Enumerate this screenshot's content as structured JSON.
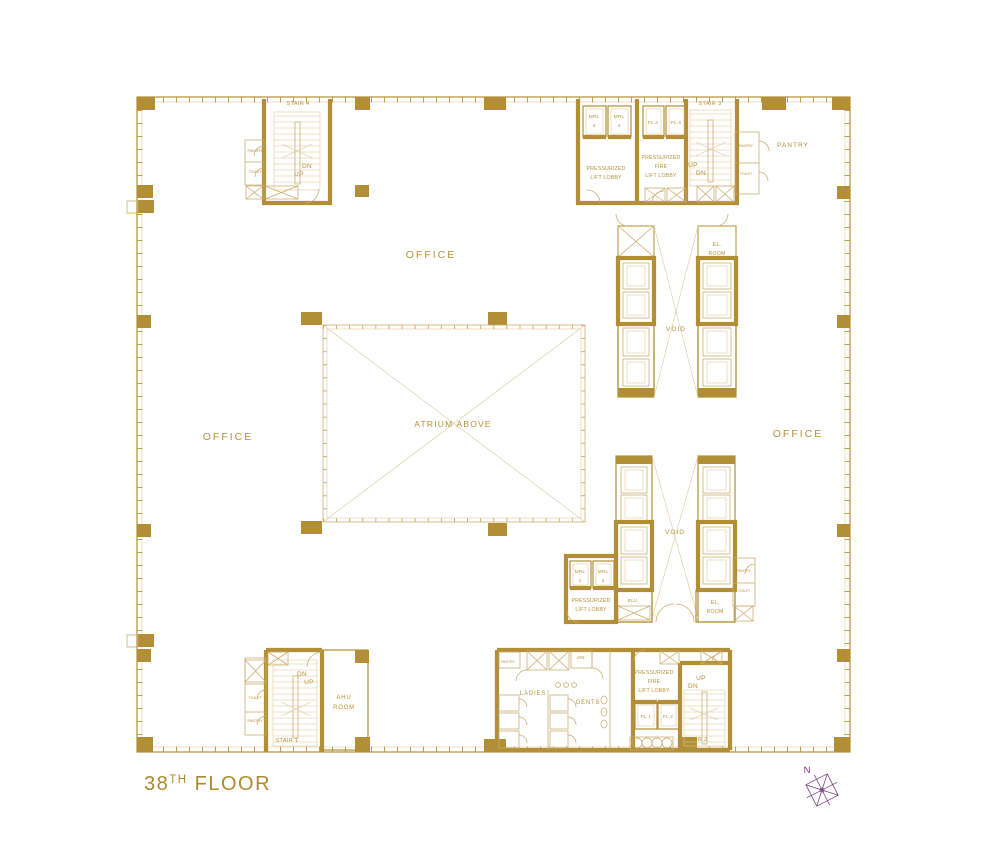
{
  "colors": {
    "gold_wall": "#b28f36",
    "gold_light": "#c9ab6e",
    "gold_text": "#b6923a",
    "compass_purple": "#7d3f87",
    "background": "#ffffff"
  },
  "title": {
    "number": "38",
    "ordinal": "TH",
    "word": " FLOOR"
  },
  "compass": {
    "north": "N"
  },
  "zones": {
    "office_top": "OFFICE",
    "office_left": "OFFICE",
    "office_right": "OFFICE",
    "atrium": "ATRIUM ABOVE",
    "void_upper": "VOID",
    "void_lower": "VOID",
    "pantry_room": "PANTRY"
  },
  "stair4": {
    "name": "STAIR 4",
    "dn": "DN",
    "up": "UP",
    "pantry": "PANTRY",
    "toilet": "TOILET"
  },
  "core_top_right": {
    "mrl3": [
      "MRL",
      "3"
    ],
    "mrl4": [
      "MRL",
      "4"
    ],
    "lift_lobby": [
      "PRESSURIZED",
      "LIFT LOBBY"
    ],
    "fl3": "FL 3",
    "fl4": "FL 4",
    "fire_lift_lobby": [
      "PRESSURIZED",
      "FIRE",
      "LIFT LOBBY"
    ],
    "stair3": "STAIR 3",
    "up": "UP",
    "dn": "DN",
    "pantry": "PANTRY",
    "toilet": "TOILET",
    "el_room": [
      "EL.",
      "ROOM"
    ]
  },
  "core_mid_right": {
    "mrl1": [
      "MRL",
      "1"
    ],
    "mrl2": [
      "MRL",
      "2"
    ],
    "lift_lobby": [
      "PRESSURIZED",
      "LIFT LOBBY"
    ],
    "elv": "ELV.",
    "el_room": [
      "EL.",
      "ROOM"
    ],
    "pantry": "PANTRY",
    "toilet": "TOILET"
  },
  "stair1": {
    "name": "STAIR 1",
    "dn": "DN",
    "up": "UP",
    "toilet": "TOILET",
    "pantry": "PANTRY",
    "ahu_room": [
      "AHU",
      "ROOM"
    ]
  },
  "washrooms": {
    "pantry": "PANTRY",
    "jan": "JAN.",
    "ladies": "LADIES",
    "gents": "GENTS"
  },
  "core_bottom_right": {
    "fire_lift_lobby": [
      "PRESSURIZED",
      "FIRE",
      "LIFT LOBBY"
    ],
    "fl1": "FL 1",
    "fl2": "FL 2",
    "stair2": "STAIR 2",
    "up": "UP",
    "dn": "DN"
  }
}
